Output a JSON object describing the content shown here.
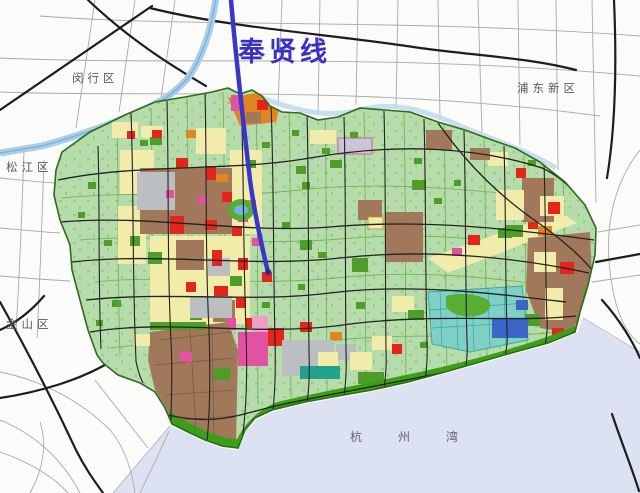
{
  "map": {
    "metro_line": {
      "label": "奉贤线",
      "label_color": "#3b2fc4",
      "stroke": "#3b35cc"
    },
    "neighboring_districts": {
      "minhang": "闵行区",
      "pudong": "浦东新区",
      "songjiang": "松江区",
      "jinshan": "金山区"
    },
    "water": {
      "bay": "杭州湾"
    },
    "colors": {
      "district_fill": "#b7dcab",
      "district_border": "#2f6a1d",
      "sea": "#dce2f1",
      "river": "#a9cfe8",
      "residential_yellow": "#f1eca9",
      "industrial_brown": "#a1795a",
      "red_zone": "#e3261b",
      "orange_zone": "#e0851f",
      "magenta_zone": "#e352a2",
      "pink_zone": "#ef9ec5",
      "green_space": "#4d9d28",
      "coastal_green": "#3ba016",
      "gray_zone": "#bcbfc2",
      "lavender_zone": "#c9c6da",
      "cyan_zone": "#7ccfc9",
      "blue_zone": "#3a66c8",
      "road_black": "#1d1d1d",
      "road_gray": "#a8a8a8"
    }
  }
}
